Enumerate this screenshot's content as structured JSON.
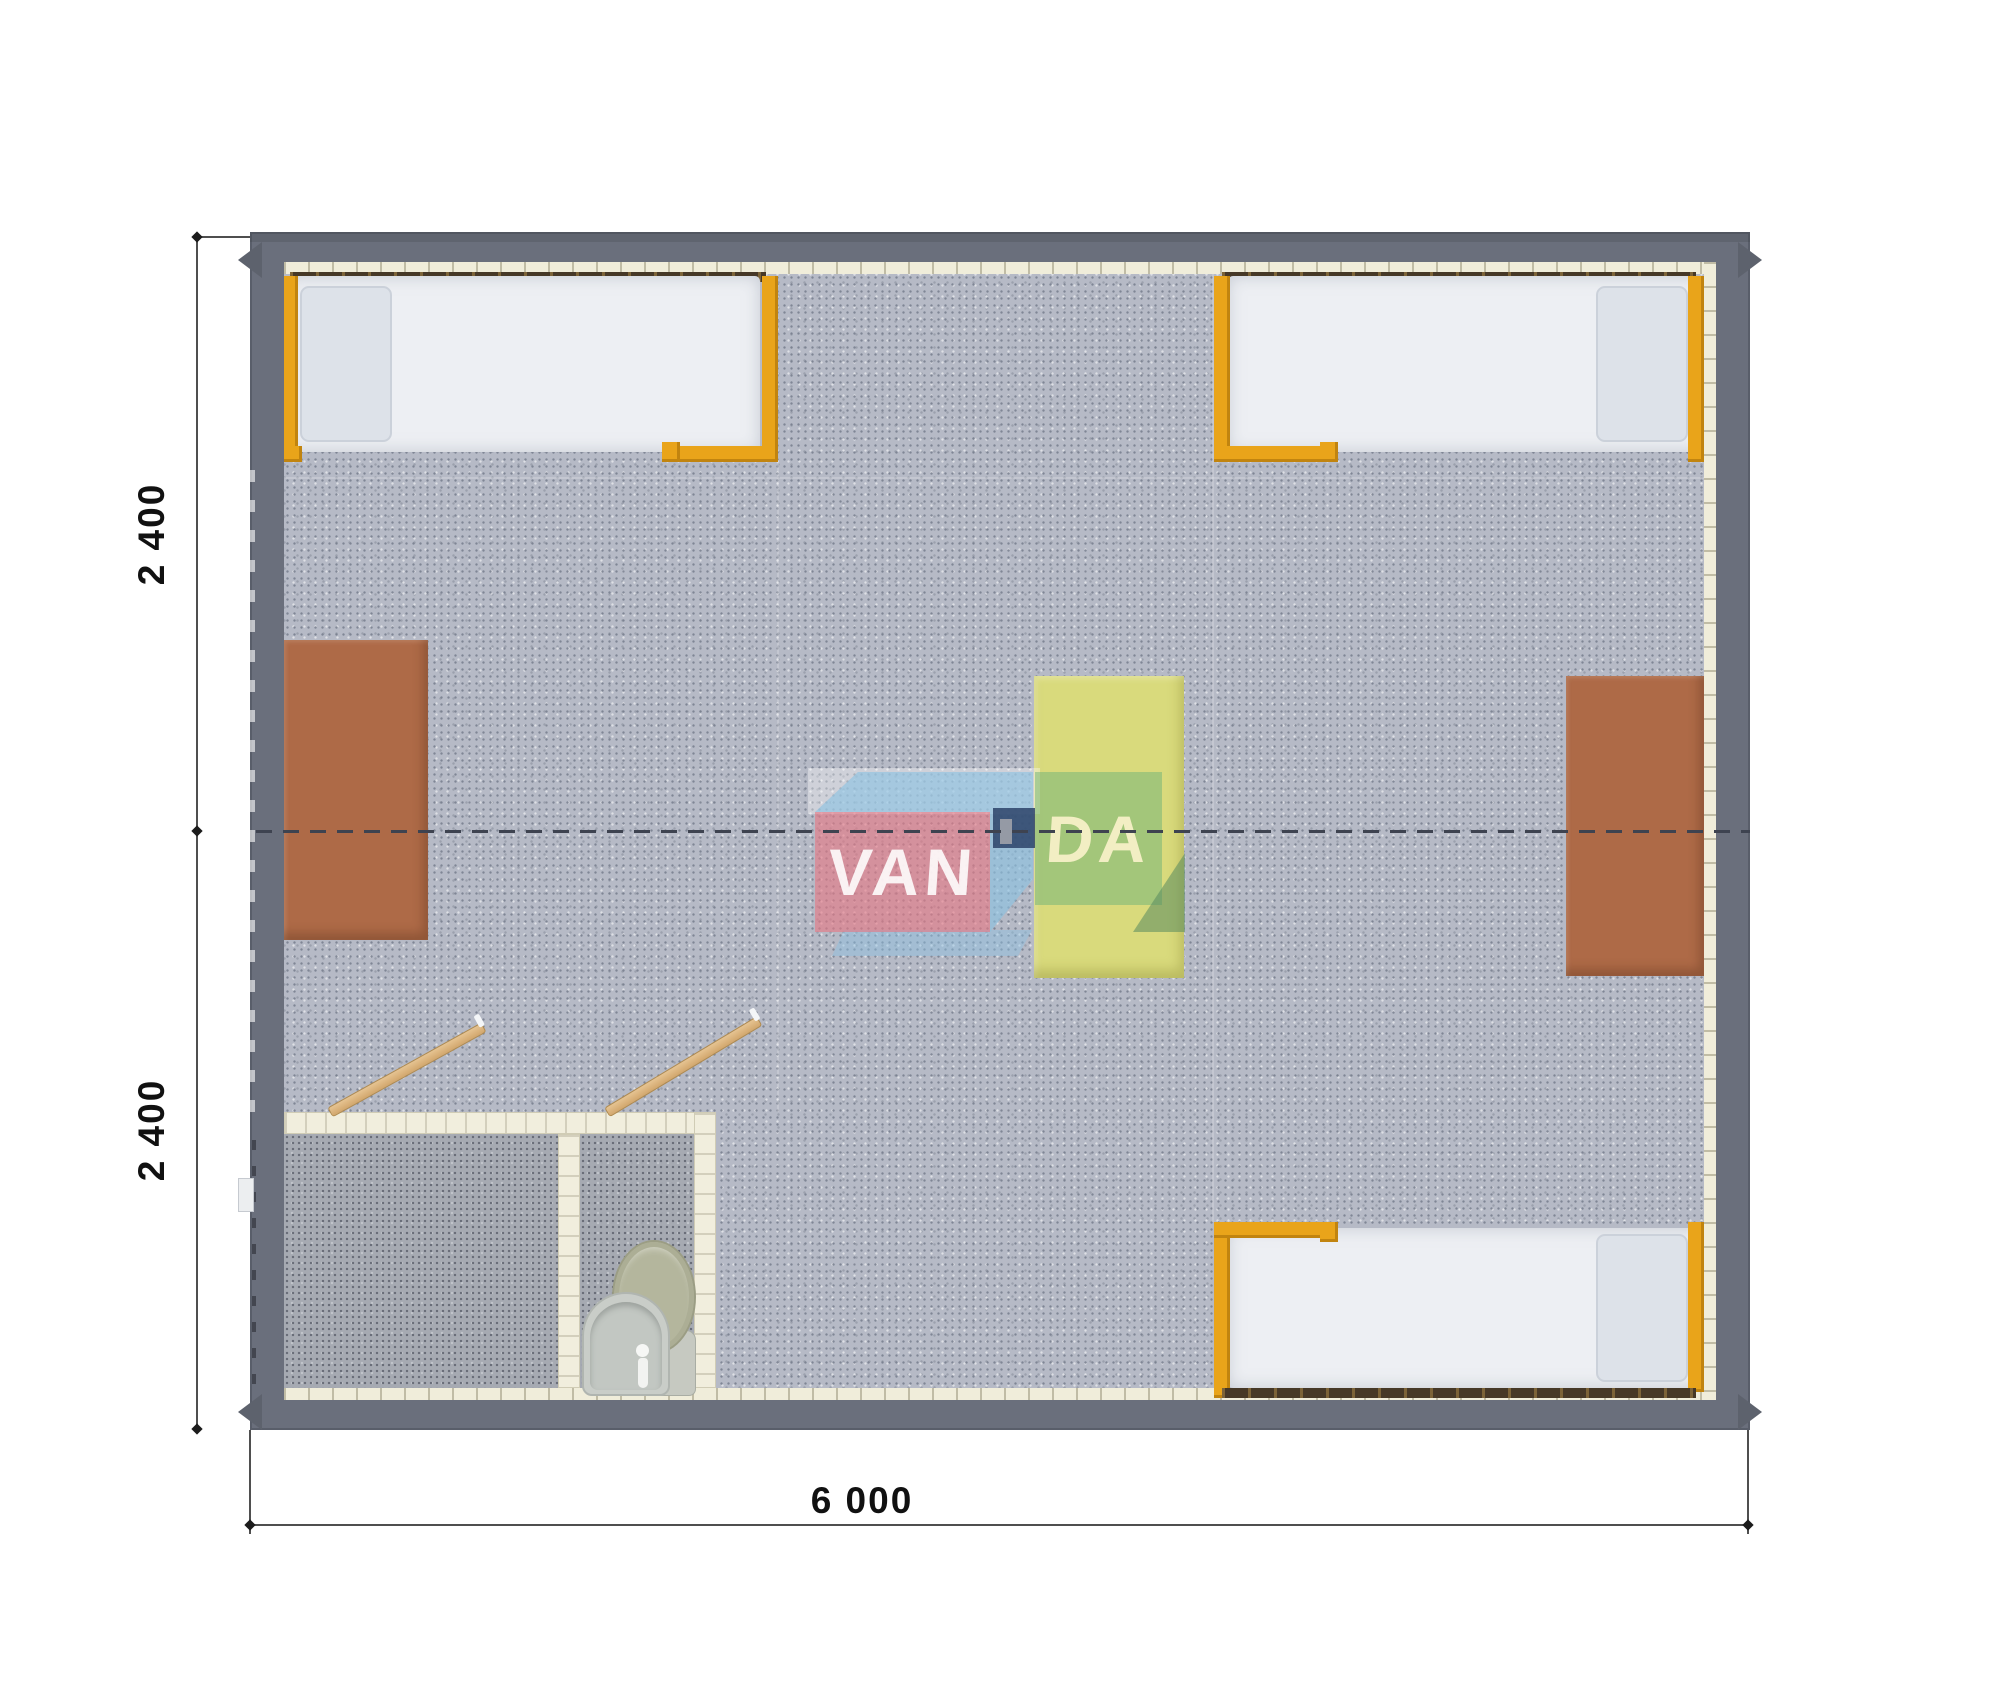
{
  "diagram": {
    "kind": "floor-plan",
    "description": "Top-down 3D render floor plan of a 6000 x 4800 modular cabin with three beds, two desks, a table and a bathroom block",
    "watermark_brand": "VANDA"
  },
  "dimensions": {
    "left_top": "2 400",
    "left_bottom": "2 400",
    "bottom": "6 000",
    "values_mm": {
      "left_segments": [
        2400,
        2400
      ],
      "bottom_total": 6000
    }
  },
  "watermark": {
    "text_left": "VAN",
    "text_right": "DA",
    "full": "VANDA"
  },
  "furniture": [
    "bed-top-left",
    "bed-top-right",
    "bed-bottom-right",
    "desk-left",
    "desk-right",
    "table-center",
    "bathroom-room-left",
    "bathroom-room-wc",
    "toilet",
    "sink",
    "door-bathroom-left",
    "door-bathroom-right"
  ],
  "colors": {
    "wall": "#6a6f7c",
    "wall_lining": "#f0edda",
    "floor": "#b6bac6",
    "bath_floor": "#a6aab2",
    "bath_wall": "#f1eedd",
    "bed_frame_orange": "#e9a41a",
    "mattress": "#edeff3",
    "pillow": "#dde2e9",
    "desk_brown": "#ae6a47",
    "table_yellow": "#d9da7c",
    "door_wood": "#d9b27c",
    "toilet_lid": "#b4b69d",
    "fixture": "#c7cbc4",
    "center_dash": "#3e4350",
    "dimension_text": "#111111",
    "logo_red": "#e77a86",
    "logo_blue": "#8bc1e2",
    "logo_green": "#6eb278",
    "logo_navy": "#2b4268"
  }
}
